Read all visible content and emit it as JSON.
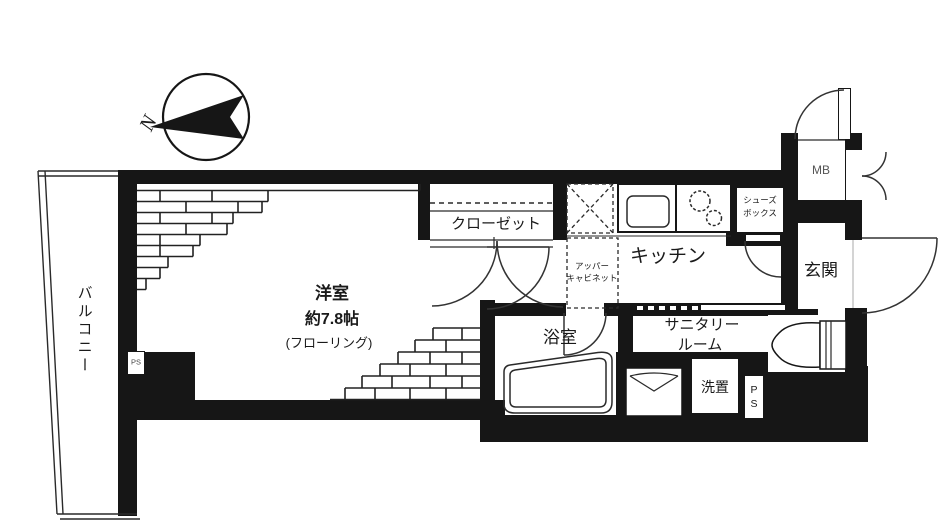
{
  "north": {
    "label": "N"
  },
  "balcony": {
    "label": "バルコニー"
  },
  "main_room": {
    "name": "洋室",
    "size": "約7.8帖",
    "floor_type": "(フローリング)"
  },
  "closet": {
    "label": "クローゼット"
  },
  "kitchen": {
    "label": "キッチン"
  },
  "upper_cabinet": {
    "line1": "アッパー",
    "line2": "キャビネット"
  },
  "shoes_box": {
    "line1": "シューズ",
    "line2": "ボックス"
  },
  "meter_box": {
    "label": "MB"
  },
  "entrance": {
    "label": "玄関"
  },
  "bathroom": {
    "label": "浴室"
  },
  "sanitary_room": {
    "line1": "サニタリー",
    "line2": "ルーム"
  },
  "laundry": {
    "label": "洗置"
  },
  "pipe_space_room": {
    "label": "PS"
  },
  "pipe_space_sanitary": {
    "line1": "P",
    "line2": "S"
  },
  "colors": {
    "wall": "#161616",
    "line": "#2a2a2a",
    "background": "#ffffff"
  }
}
